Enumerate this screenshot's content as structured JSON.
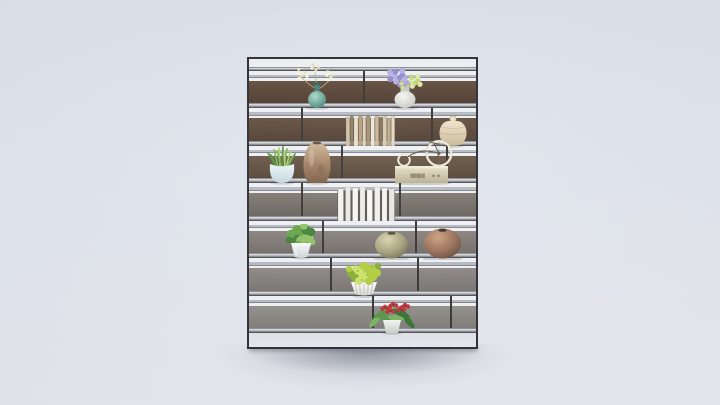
{
  "scene": {
    "width": 720,
    "height": 405,
    "background": {
      "top": "#dce1e9",
      "mid": "#dfe3eb",
      "bottom": "#e7e9ed"
    },
    "floor_shadows": [
      {
        "x": 210,
        "y": 344,
        "w": 310,
        "h": 48,
        "color": "rgba(120,126,140,0.28)"
      },
      {
        "x": 240,
        "y": 346,
        "w": 250,
        "h": 30,
        "color": "rgba(95,100,112,0.50)"
      }
    ],
    "contact_shadow": {
      "x": 249,
      "y": 347,
      "w": 228,
      "h": 4,
      "color": "rgba(70,72,80,0.55)"
    }
  },
  "shelf": {
    "x": 247,
    "y": 57,
    "width": 231,
    "height": 292,
    "frame_color": "#232328",
    "gap_color": "#eef0f3",
    "rail_color": "#b3b7bd",
    "divider_color": "#2e2b27",
    "top_gap": 8,
    "rail_h": 3.5,
    "sections": [
      {
        "gap": 10,
        "panel": 22.5,
        "plate": 5,
        "panel_c1": "#5c4532",
        "panel_c2": "#453226",
        "dividers": [
          363
        ]
      },
      {
        "gap": 10,
        "panel": 22.5,
        "plate": 5,
        "panel_c1": "#5e4836",
        "panel_c2": "#47362a",
        "dividers": [
          301,
          431
        ]
      },
      {
        "gap": 10,
        "panel": 22.5,
        "plate": 5,
        "panel_c1": "#63503e",
        "panel_c2": "#4d3c2e",
        "dividers": [
          341,
          446
        ]
      },
      {
        "gap": 10,
        "panel": 22.5,
        "plate": 5,
        "panel_c1": "#79736b",
        "panel_c2": "#615b53",
        "dividers": [
          301,
          399
        ]
      },
      {
        "gap": 10,
        "panel": 22.5,
        "plate": 5,
        "panel_c1": "#837d77",
        "panel_c2": "#6c6660",
        "dividers": [
          322,
          415
        ]
      },
      {
        "gap": 10,
        "panel": 22.5,
        "plate": 5,
        "panel_c1": "#898380",
        "panel_c2": "#726d69",
        "dividers": [
          330,
          417
        ]
      },
      {
        "gap": 10,
        "panel": 22.5,
        "plate": 5,
        "panel_c1": "#8e8a86",
        "panel_c2": "#797570",
        "dividers": [
          372,
          450
        ]
      }
    ],
    "bottom_color1": "#dfe2e7",
    "bottom_color2": "#e6e8ec"
  },
  "items": [
    {
      "name": "celadon-flower-vase",
      "type": "flower-vase",
      "cx": 317,
      "baseline": 108,
      "vase": {
        "w": 18,
        "bh": 17,
        "h": 24,
        "neckW": 5,
        "c1": "#a7dbc9",
        "c2": "#3e7c71",
        "c3": "#2e5c55"
      },
      "stem": "#b5ae8a",
      "clusters": [
        {
          "dx": -16,
          "dy": -34,
          "r": 7,
          "n": 6,
          "dr": 1.6,
          "c": "#ece6b2",
          "c2": "#f8f4da"
        },
        {
          "dx": -2,
          "dy": -39,
          "r": 6,
          "n": 5,
          "dr": 1.5,
          "c": "#e4dda6",
          "c2": "#f6f2d2"
        },
        {
          "dx": 13,
          "dy": -32,
          "r": 6,
          "n": 5,
          "dr": 1.5,
          "c": "#eee8bc",
          "c2": "#fbf8e0"
        }
      ]
    },
    {
      "name": "hydrangea-vase",
      "type": "flower-vase",
      "cx": 405,
      "baseline": 108,
      "vase": {
        "w": 21,
        "bh": 17,
        "h": 25,
        "neckW": 9,
        "c1": "#f5f5f1",
        "c2": "#c7c7bf",
        "c3": "#b6b6ae"
      },
      "stem": null,
      "clusters": [
        {
          "dx": -7,
          "dy": -31,
          "r": 10,
          "n": 10,
          "dr": 3,
          "c": "#9186cb",
          "c2": "#b4abe1"
        },
        {
          "dx": 9,
          "dy": -26,
          "r": 8,
          "n": 8,
          "dr": 2.6,
          "c": "#c2d377",
          "c2": "#dde9a4"
        },
        {
          "dx": -1,
          "dy": -24,
          "r": 5,
          "n": 4,
          "dr": 2.2,
          "c": "#a79ed6",
          "c2": "#cdd98c"
        }
      ]
    },
    {
      "name": "tan-books-row",
      "type": "books",
      "x": 345,
      "baseline": 146,
      "gap": 0.5,
      "spines": [
        {
          "w": 3.8,
          "h": 29,
          "c": "#cdbd9f"
        },
        {
          "w": 3.2,
          "h": 30,
          "c": "#8a7a60"
        },
        {
          "w": 4.0,
          "h": 28,
          "c": "#e6ddc8"
        },
        {
          "w": 3.6,
          "h": 30,
          "c": "#b49c79"
        },
        {
          "w": 3.2,
          "h": 29,
          "c": "#dcd1b8"
        },
        {
          "w": 4.0,
          "h": 30,
          "c": "#9d8c6f"
        },
        {
          "w": 3.8,
          "h": 28,
          "c": "#ece6d6"
        },
        {
          "w": 3.6,
          "h": 30,
          "c": "#c6b593"
        },
        {
          "w": 3.0,
          "h": 29,
          "c": "#7e6d55"
        },
        {
          "w": 4.0,
          "h": 30,
          "c": "#d5c8ab"
        },
        {
          "w": 3.6,
          "h": 28,
          "c": "#baa886"
        },
        {
          "w": 3.4,
          "h": 30,
          "c": "#e2d8c2"
        }
      ]
    },
    {
      "name": "gourd-jar",
      "type": "jar",
      "cx": 453,
      "baseline": 146,
      "c1": "#ebdfc4",
      "c2": "#c7b68e",
      "line": "#a8976f"
    },
    {
      "name": "grass-plant",
      "type": "potted-grass",
      "cx": 282,
      "baseline": 183,
      "pot": {
        "c1": "#edf4f6",
        "c2": "#bfd6dc"
      },
      "grass": {
        "c1": "#4e8b36",
        "c2": "#79b24c",
        "c3": "#a5d06c"
      }
    },
    {
      "name": "brown-urn-vase",
      "type": "urn",
      "cx": 317,
      "baseline": 183,
      "c1": "#c8ac8b",
      "c2": "#9b7a5a",
      "c3": "#74573c",
      "mouth": "#5a4630"
    },
    {
      "name": "bicycle-radio",
      "type": "bicycle-radio",
      "x": 395,
      "baseline": 183,
      "base": {
        "c1": "#e6dfc6",
        "c2": "#b6ab8d",
        "grille": "#968b6d",
        "face": "#efe9d2"
      },
      "bike": {
        "wheel": "#eee9da",
        "line": "#575039"
      }
    },
    {
      "name": "white-books-row",
      "type": "books",
      "x": 337,
      "baseline": 221,
      "gap": 2,
      "gapColor": "#56524a",
      "spines": [
        {
          "w": 5.5,
          "h": 32,
          "c": "#f3f2ef"
        },
        {
          "w": 5.0,
          "h": 34,
          "c": "#e9e8e4"
        },
        {
          "w": 5.5,
          "h": 33,
          "c": "#f6f5f2"
        },
        {
          "w": 5.0,
          "h": 34,
          "c": "#ecebe7"
        },
        {
          "w": 5.5,
          "h": 31,
          "c": "#f8f7f4"
        },
        {
          "w": 5.5,
          "h": 34,
          "c": "#f0efeb"
        },
        {
          "w": 5.0,
          "h": 33,
          "c": "#f4f3f0"
        },
        {
          "w": 5.5,
          "h": 32,
          "c": "#e7e5e1"
        }
      ]
    },
    {
      "name": "bush-plant",
      "type": "bush-pot",
      "cx": 301,
      "baseline": 258,
      "pot": {
        "c1": "#f8fafa",
        "c2": "#ccd3d5"
      },
      "foliage": {
        "c1": "#3c7a30",
        "c2": "#619f43",
        "c3": "#8ac05c"
      }
    },
    {
      "name": "olive-glass-vase",
      "type": "round-vase",
      "cx": 391,
      "baseline": 258,
      "w": 33,
      "h": 27,
      "c1": "#d8d2ab",
      "c2": "#a09a73",
      "c3": "#6b674e",
      "mouth": "#4b4935"
    },
    {
      "name": "copper-vase",
      "type": "round-vase",
      "cx": 442,
      "baseline": 258,
      "w": 37,
      "h": 30,
      "c1": "#cb9d79",
      "c2": "#92664e",
      "c3": "#5c4133",
      "mouth": "#33271f"
    },
    {
      "name": "chartreuse-bouquet",
      "type": "bouquet",
      "cx": 364,
      "baseline": 296,
      "vase": {
        "c1": "#ffffff",
        "c2": "#d6d6d0",
        "pleat": "#c4c4bd"
      },
      "flowers": {
        "c1": "#aecb36",
        "c2": "#cbe260",
        "c3": "#83aa2b"
      }
    },
    {
      "name": "red-flower-plant",
      "type": "flowering-plant",
      "cx": 392,
      "baseline": 333,
      "pot": {
        "c1": "#f5f5f3",
        "c2": "#caccc8"
      },
      "leaves": {
        "c1": "#2e6a2c",
        "c2": "#4f9340",
        "c3": "#74b156"
      },
      "blooms": {
        "c": "#bc2a31",
        "c2": "#7e181e",
        "dots": [
          [
            -7,
            -26
          ],
          [
            1,
            -29
          ],
          [
            9,
            -25
          ],
          [
            -2,
            -23
          ],
          [
            13,
            -28
          ]
        ]
      }
    }
  ]
}
